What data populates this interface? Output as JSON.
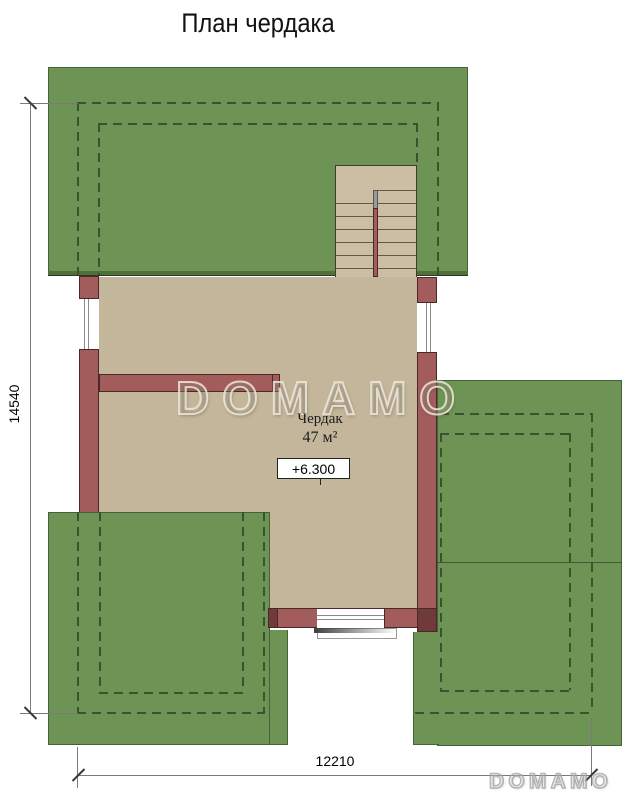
{
  "title": "План чердака",
  "room_label": {
    "name": "Чердак",
    "area": "47 м²"
  },
  "level_marker": {
    "value": "+6.300"
  },
  "dimensions": {
    "vertical": "14540",
    "horizontal": "12210"
  },
  "watermarks": {
    "center": "DOMAMO",
    "corner": "DOMAMO"
  },
  "colors": {
    "roof-green": "#6e9455",
    "roof-outline": "#44633a",
    "floor-beige": "#c4b69b",
    "stair-beige": "#ccbea4",
    "wall-maroon": "#a25c5c",
    "wall-outline": "#4b2828",
    "wall-dark": "#713a3a",
    "dash-color": "#3a5230",
    "dim-line": "#7a7a7a",
    "text-color": "#111111"
  }
}
